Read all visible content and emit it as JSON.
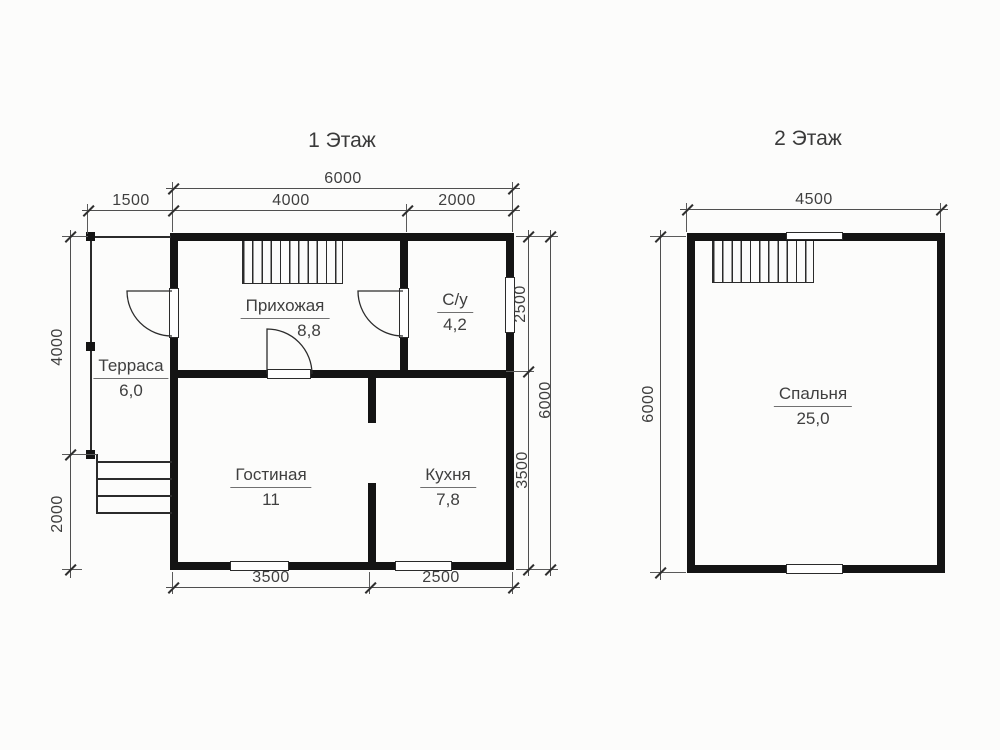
{
  "colors": {
    "wall": "#141414",
    "line": "#2b2b2b",
    "text": "#3f3f3f",
    "background": "#fcfcfb"
  },
  "floor1": {
    "title": "1 Этаж",
    "rooms": {
      "hallway": {
        "name": "Прихожая",
        "area": "8,8"
      },
      "bathroom": {
        "name": "С/у",
        "area": "4,2"
      },
      "terrace": {
        "name": "Терраса",
        "area": "6,0"
      },
      "living": {
        "name": "Гостиная",
        "area": "11"
      },
      "kitchen": {
        "name": "Кухня",
        "area": "7,8"
      }
    },
    "dims": {
      "top_total": "6000",
      "top_left": "1500",
      "top_mid": "4000",
      "top_right": "2000",
      "left_top": "4000",
      "left_bottom": "2000",
      "right_inner_top": "2500",
      "right_inner_bottom": "3500",
      "right_outer": "6000",
      "bottom_left": "3500",
      "bottom_right": "2500"
    }
  },
  "floor2": {
    "title": "2 Этаж",
    "rooms": {
      "bedroom": {
        "name": "Спальня",
        "area": "25,0"
      }
    },
    "dims": {
      "top_total": "4500",
      "left_total": "6000"
    }
  }
}
